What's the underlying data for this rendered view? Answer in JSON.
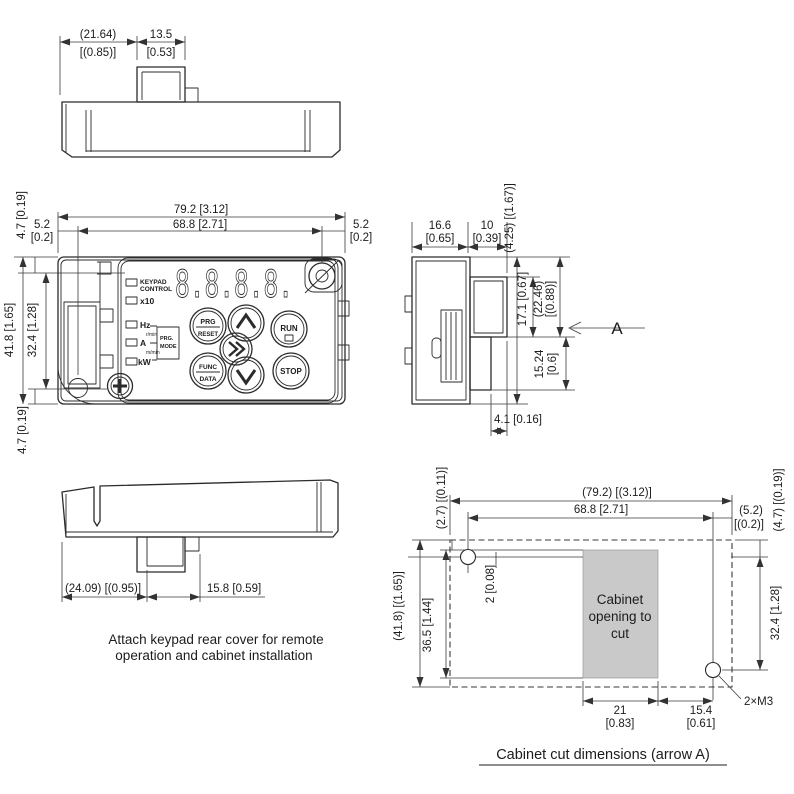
{
  "top_view": {
    "dim_width_ref": "(21.64)",
    "dim_width_ref_in": "[(0.85)]",
    "dim_tab": "13.5",
    "dim_tab_in": "[0.53]"
  },
  "front_view": {
    "dim_total_width": "79.2 [3.12]",
    "dim_hole_span": "68.8 [2.71]",
    "dim_left_offset": "5.2",
    "dim_left_offset_in": "[0.2]",
    "dim_right_offset": "5.2",
    "dim_right_offset_in": "[0.2]",
    "dim_top_offset": "4.7 [0.19]",
    "dim_total_height": "41.8 [1.65]",
    "dim_hole_height": "32.4 [1.28]",
    "dim_bottom_offset": "4.7 [0.19]",
    "keypad": {
      "display_value": "8.8.8.8.",
      "indicators": {
        "keypad_line1": "KEYPAD",
        "keypad_line2": "CONTROL",
        "x10": "x10",
        "hz": "Hz",
        "r_min": "r/min",
        "amp": "A",
        "m_min": "m/min",
        "kw": "kW",
        "prg_box_line1": "PRG.",
        "prg_box_line2": "MODE"
      },
      "buttons": {
        "prg": "PRG",
        "reset": "RESET",
        "run": "RUN",
        "func": "FUNC",
        "data": "DATA",
        "stop": "STOP"
      }
    }
  },
  "side_view": {
    "dim_depth_body": "16.6",
    "dim_depth_body_in": "[0.65]",
    "dim_depth_tab": "10",
    "dim_depth_tab_in": "[0.39]",
    "dim_total_height": "(4.25) [(1.67)]",
    "dim_tab_height": "17.1 [0.67]",
    "dim_tab_bottom": "(22.46)",
    "dim_tab_bottom_in": "[(0.88)]",
    "dim_lower": "15.24",
    "dim_lower_in": "[0.6]",
    "dim_foot": "4.1 [0.16]",
    "arrow_label": "A"
  },
  "rear_view": {
    "dim_left_ref": "(24.09) [(0.95)]",
    "dim_tab": "15.8 [0.59]",
    "caption_line1": "Attach keypad rear cover for remote",
    "caption_line2": "operation and cabinet installation"
  },
  "cabinet_view": {
    "dim_total_width": "(79.2) [(3.12)]",
    "dim_hole_span": "68.8 [2.71]",
    "dim_right_offset": "(5.2)",
    "dim_right_offset_in": "[(0.2)]",
    "dim_top_right": "(4.7) [(0.19)]",
    "dim_hole_height": "32.4 [1.28]",
    "dim_top_left": "(2.7) [(0.11)]",
    "dim_gap": "2 [0.08]",
    "dim_opening_height": "36.5 [1.44]",
    "dim_total_height": "(41.8) [(1.65)]",
    "dim_opening_width": "21",
    "dim_opening_width_in": "[0.83]",
    "dim_opening_right": "15.4",
    "dim_opening_right_in": "[0.61]",
    "hole_label": "2×M3",
    "opening_line1": "Cabinet",
    "opening_line2": "opening to",
    "opening_line3": "cut",
    "opening_fill": "#c9c9c9",
    "caption": "Cabinet cut dimensions (arrow A)"
  }
}
